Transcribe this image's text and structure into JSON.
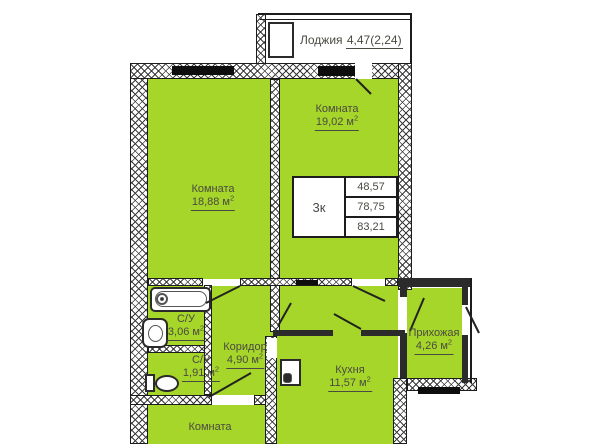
{
  "colors": {
    "room_fill": "#a6d629",
    "text": "#4a4a42",
    "line": "#222222"
  },
  "rooms": {
    "loggia": {
      "label": "Лоджия",
      "area": "4,47(2,24)",
      "sup": ""
    },
    "room_top_right": {
      "label": "Комната",
      "area": "19,02 м",
      "sup": "2"
    },
    "room_top_left": {
      "label": "Комната",
      "area": "18,88 м",
      "sup": "2"
    },
    "bathroom_main": {
      "label": "С/У",
      "area": "3,06 м",
      "sup": "2"
    },
    "bathroom_small": {
      "label": "С/У",
      "area": "1,91 м",
      "sup": "2"
    },
    "corridor": {
      "label": "Коридор",
      "area": "4,90 м",
      "sup": "2"
    },
    "kitchen": {
      "label": "Кухня",
      "area": "11,57 м",
      "sup": "2"
    },
    "hallway": {
      "label": "Прихожая",
      "area": "4,26 м",
      "sup": "2"
    },
    "room_bottom": {
      "label": "Комната"
    }
  },
  "table": {
    "type": "3к",
    "rows": [
      "48,57",
      "78,75",
      "83,21"
    ]
  }
}
